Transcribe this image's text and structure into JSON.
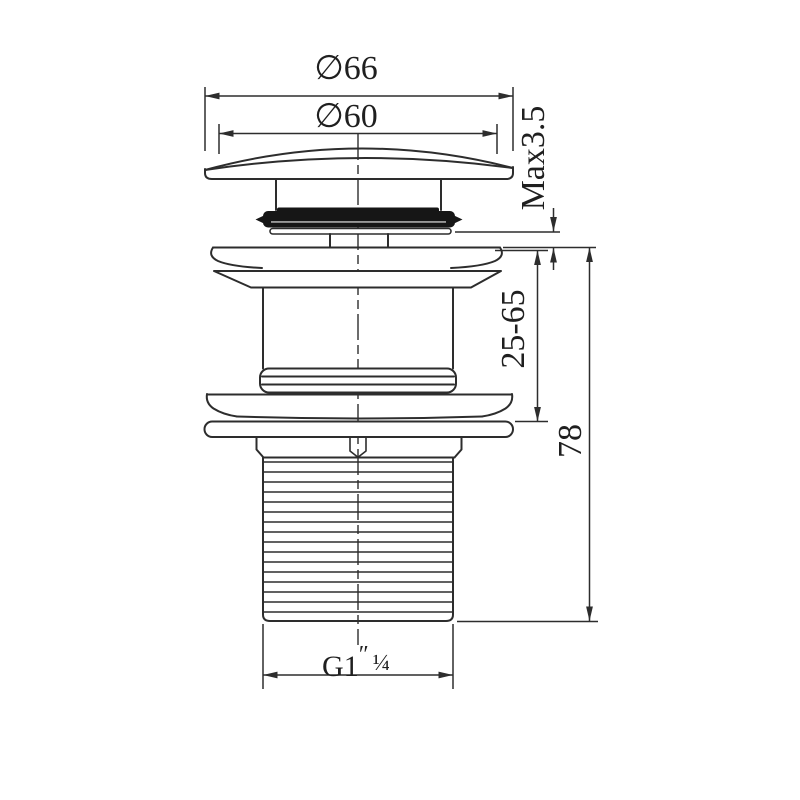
{
  "drawing": {
    "type": "technical-drawing",
    "subject": "basin pop-up waste fitting, side section view",
    "background_color": "#ffffff",
    "line_color": "#2d2d2d",
    "seal_color": "#161616",
    "dimensions": {
      "outer_diameter": {
        "label": "∅66",
        "orientation": "horizontal"
      },
      "inner_diameter": {
        "label": "∅60",
        "orientation": "horizontal"
      },
      "max_deck": {
        "label": "Max3.5",
        "orientation": "vertical"
      },
      "clamping_range": {
        "label": "25-65",
        "orientation": "vertical"
      },
      "overall_height": {
        "label": "78",
        "orientation": "vertical"
      },
      "thread": {
        "g": "G1",
        "prime": "″",
        "fraction": "¼",
        "orientation": "horizontal"
      }
    }
  }
}
